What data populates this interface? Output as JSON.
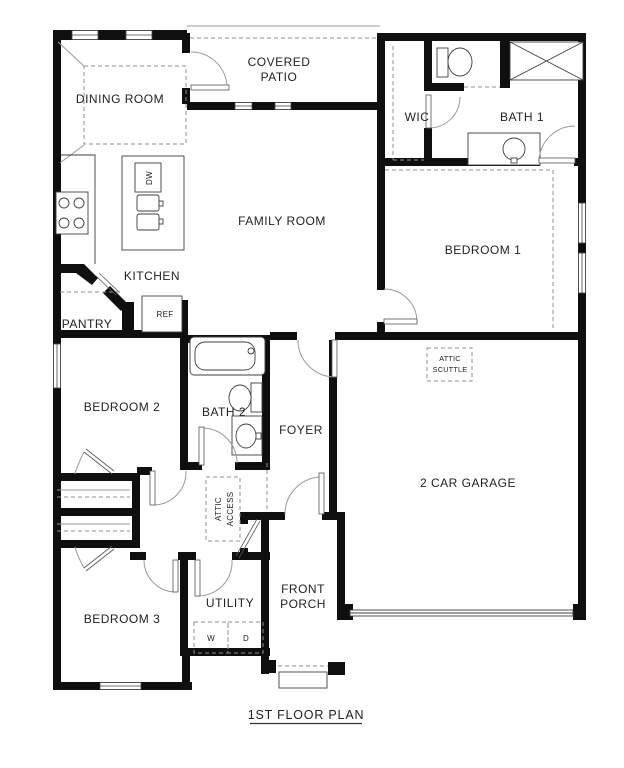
{
  "page": {
    "title": "1ST FLOOR PLAN"
  },
  "colors": {
    "wall": "#0f0f0f",
    "fixture_line": "#3f3f3f",
    "dash_line": "#8f8f8f",
    "door_line": "#9a9a9a",
    "text": "#1f1f1f",
    "background": "#ffffff"
  },
  "rooms": {
    "dining": "DINING ROOM",
    "covered_patio_line1": "COVERED",
    "covered_patio_line2": "PATIO",
    "wic": "WIC",
    "bath1": "BATH 1",
    "family": "FAMILY ROOM",
    "bedroom1": "BEDROOM 1",
    "kitchen": "KITCHEN",
    "pantry": "PANTRY",
    "bedroom2": "BEDROOM 2",
    "bath2": "BATH 2",
    "foyer": "FOYER",
    "garage": "2 CAR GARAGE",
    "bedroom3": "BEDROOM 3",
    "utility": "UTILITY",
    "front_porch_line1": "FRONT",
    "front_porch_line2": "PORCH"
  },
  "fixtures": {
    "dishwasher": "DW",
    "refrigerator": "REF",
    "washer": "W",
    "dryer": "D",
    "attic_scuttle_line1": "ATTIC",
    "attic_scuttle_line2": "SCUTTLE",
    "attic_access_line1": "ATTIC",
    "attic_access_line2": "ACCESS"
  }
}
